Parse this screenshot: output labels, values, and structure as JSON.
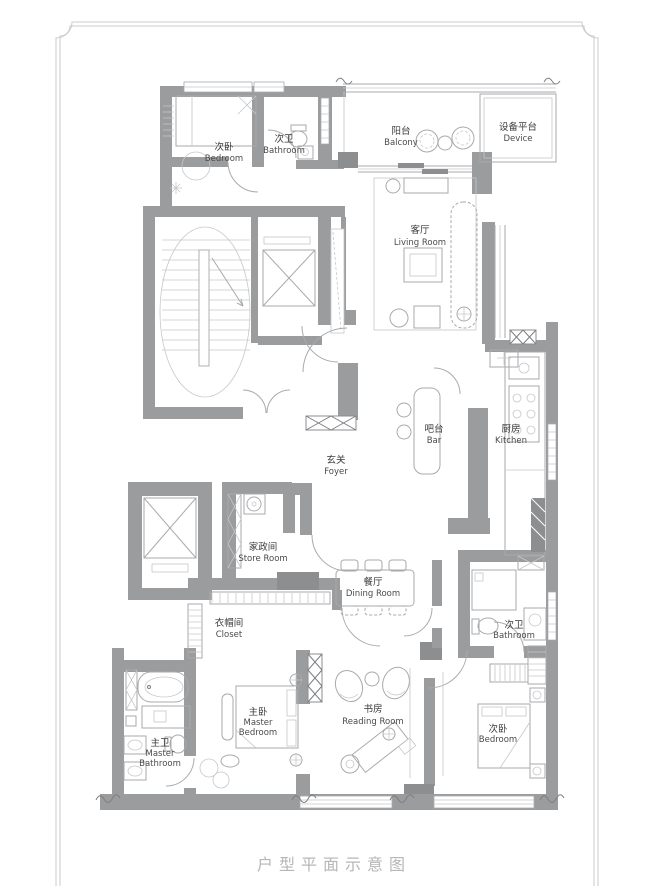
{
  "caption": "户型平面示意图",
  "colors": {
    "wall": "#9b9c9e",
    "wall_dark": "#8d8e90",
    "line": "#a8aaac",
    "label": "#3a3a3a",
    "caption": "#b6b6b6",
    "frame": "#cbcbcb",
    "background": "#ffffff"
  },
  "rooms": [
    {
      "id": "bedroom-north",
      "zh": "次卧",
      "en": "Bedroom"
    },
    {
      "id": "bathroom-north",
      "zh": "次卫",
      "en": "Bathroom"
    },
    {
      "id": "balcony",
      "zh": "阳台",
      "en": "Balcony"
    },
    {
      "id": "device-platform",
      "zh": "设备平台",
      "en": "Device"
    },
    {
      "id": "living-room",
      "zh": "客厅",
      "en": "Living Room"
    },
    {
      "id": "foyer",
      "zh": "玄关",
      "en": "Foyer"
    },
    {
      "id": "bar",
      "zh": "吧台",
      "en": "Bar"
    },
    {
      "id": "kitchen",
      "zh": "厨房",
      "en": "Kitchen"
    },
    {
      "id": "store-room",
      "zh": "家政间",
      "en": "Store Room"
    },
    {
      "id": "closet",
      "zh": "衣帽间",
      "en": "Closet"
    },
    {
      "id": "dining-room",
      "zh": "餐厅",
      "en": "Dining Room"
    },
    {
      "id": "bathroom-east",
      "zh": "次卫",
      "en": "Bathroom"
    },
    {
      "id": "master-bathroom",
      "zh": "主卫",
      "en": "Master",
      "en2": "Bathroom"
    },
    {
      "id": "master-bedroom",
      "zh": "主卧",
      "en": "Master",
      "en2": "Bedroom"
    },
    {
      "id": "reading-room",
      "zh": "书房",
      "en": "Reading Room"
    },
    {
      "id": "bedroom-southeast",
      "zh": "次卧",
      "en": "Bedroom"
    }
  ]
}
